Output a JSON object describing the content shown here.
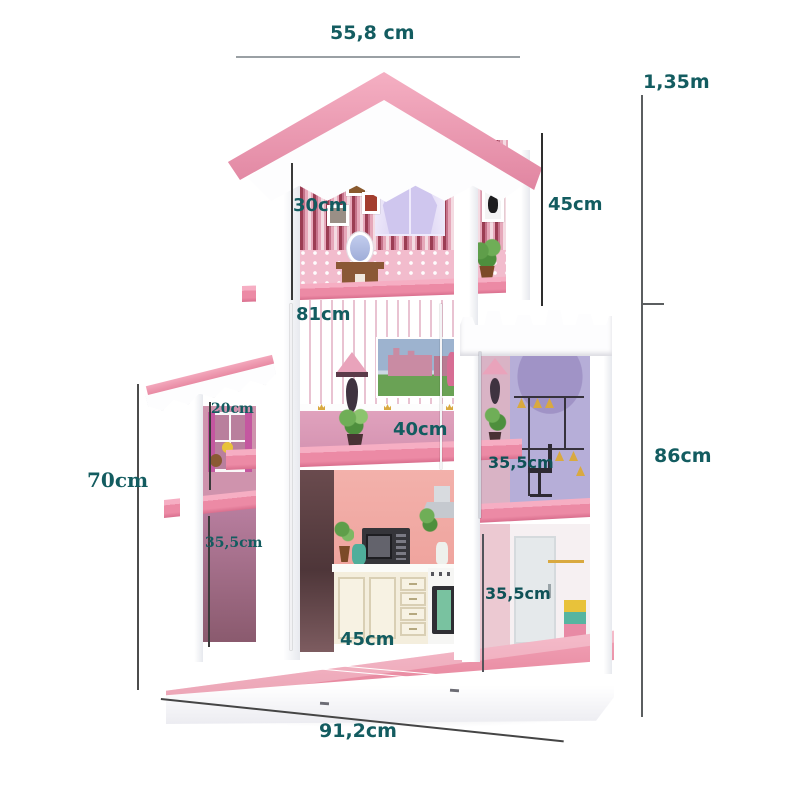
{
  "subject": "Pink dollhouse shelf dimension diagram",
  "colors": {
    "label_teal": "#135c60",
    "roof_pink": "#f0a2b8",
    "shelf_pink": "#ee8ca7",
    "base_pink": "#e8849b",
    "stripe_wall": "#9b3d53",
    "lavender_room": "#b6aed8",
    "kitchen_wall": "#f2aca6"
  },
  "measurements": {
    "top_width": "55,8 cm",
    "total_height": "1,35m",
    "top_room_height": "30cm",
    "top_right_height": "45cm",
    "left_column_height": "81cm",
    "wing_upper_height": "20cm",
    "wing_total_height": "70cm",
    "middle_room_height": "40cm",
    "wing_lower_height": "35,5cm",
    "tower_middle_height": "35,5cm",
    "tower_lower_height": "35,5cm",
    "right_section_height": "86cm",
    "kitchen_width": "45cm",
    "base_width": "91,2cm"
  }
}
